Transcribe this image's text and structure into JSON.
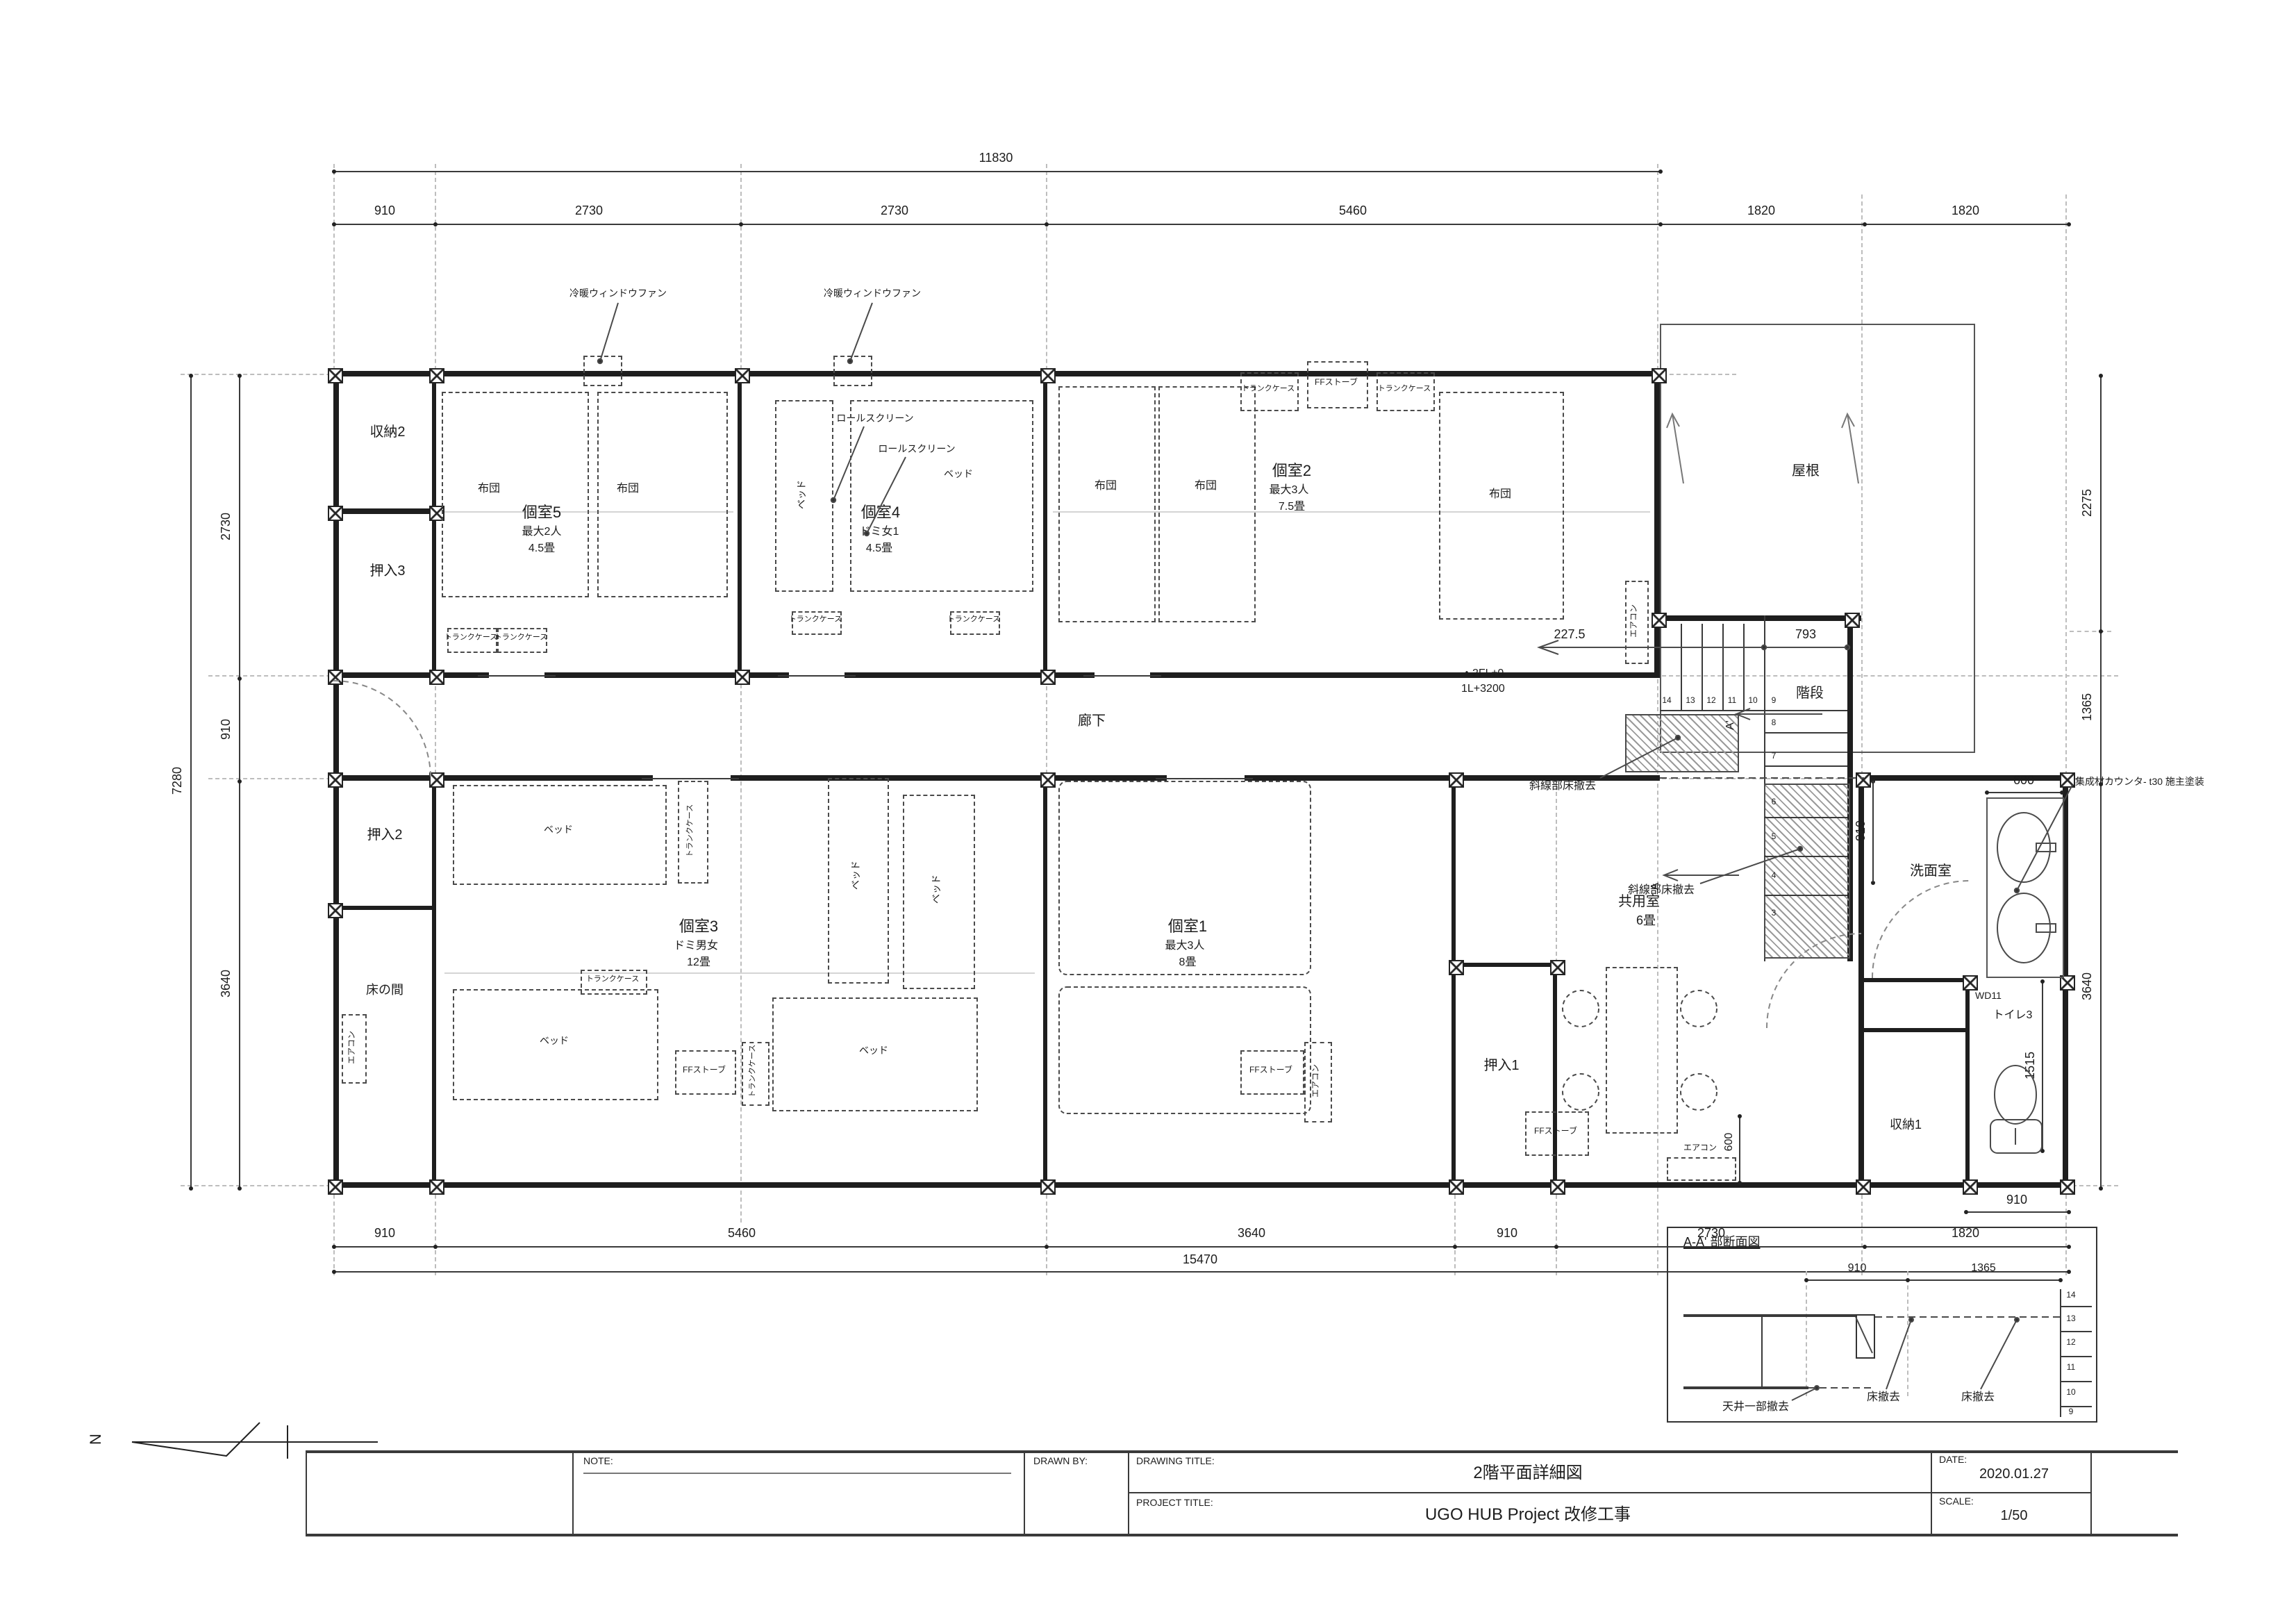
{
  "titleblock": {
    "note_label": "NOTE:",
    "drawn_by_label": "DRAWN BY:",
    "drawing_title_label": "DRAWING TITLE:",
    "drawing_title": "2階平面詳細図",
    "date_label": "DATE:",
    "date": "2020.01.27",
    "project_title_label": "PROJECT TITLE:",
    "project_title": "UGO HUB Project 改修工事",
    "scale_label": "SCALE:",
    "scale": "1/50"
  },
  "north": "N",
  "dims": {
    "top_total": "11830",
    "top": [
      "910",
      "2730",
      "2730",
      "5460",
      "1820",
      "1820"
    ],
    "left_total": "7280",
    "left": [
      "2730",
      "910",
      "3640"
    ],
    "right": [
      "2275",
      "1365",
      "3640"
    ],
    "bottom": [
      "910",
      "5460",
      "3640",
      "910",
      "2730",
      "1820"
    ],
    "bottom_total": "15470",
    "stair_offset": "227.5",
    "stair_well": "793",
    "stair_width": "910",
    "washroom_depth": "910",
    "counter_width": "600",
    "aircon_depth": "600",
    "toilet_width": "910",
    "toilet_depth": "1515"
  },
  "rooms": {
    "shuno2": "収納2",
    "oshiire3": "押入3",
    "k5": {
      "name": "個室5",
      "cap": "最大2人",
      "size": "4.5畳"
    },
    "k4": {
      "name": "個室4",
      "cap": "ドミ女1",
      "size": "4.5畳"
    },
    "k2": {
      "name": "個室2",
      "cap": "最大3人",
      "size": "7.5畳"
    },
    "roof": "屋根",
    "corridor": "廊下",
    "oshiire2": "押入2",
    "tokonoma": "床の間",
    "k3": {
      "name": "個室3",
      "cap": "ドミ男女",
      "size": "12畳"
    },
    "k1": {
      "name": "個室1",
      "cap": "最大3人",
      "size": "8畳"
    },
    "oshiire1": "押入1",
    "common": {
      "name": "共用室",
      "size": "6畳"
    },
    "washroom": "洗面室",
    "wd": "WD11",
    "toilet": "トイレ3",
    "shuno1": "収納1"
  },
  "items": {
    "futon": "布団",
    "bed": "ベッド",
    "trunk": "トランクケース",
    "stove": "FFストーブ",
    "aircon": "エアコン",
    "roll": "ロールスクリーン",
    "fan": "冷暖ウィンドウファン",
    "counter": "集成材カウンタ- t30 施主塗装"
  },
  "stairs": {
    "label": "階段",
    "level_a": "・2FL±0",
    "level_b": "1L+3200",
    "removal": "斜線部床撤去",
    "nums_run": [
      "14",
      "13",
      "12",
      "11",
      "10",
      "9"
    ],
    "nums_mid": [
      "8",
      "7"
    ],
    "nums_low": [
      "6",
      "5",
      "4",
      "3"
    ]
  },
  "markers": {
    "a": "A",
    "a_prime": "A'"
  },
  "section": {
    "title": "A-A' 部断面図",
    "dim_a": "910",
    "dim_b": "1365",
    "nums": [
      "14",
      "13",
      "12",
      "11",
      "10",
      "9"
    ],
    "floor_removal": "床撤去",
    "ceiling_removal": "天井一部撤去"
  }
}
